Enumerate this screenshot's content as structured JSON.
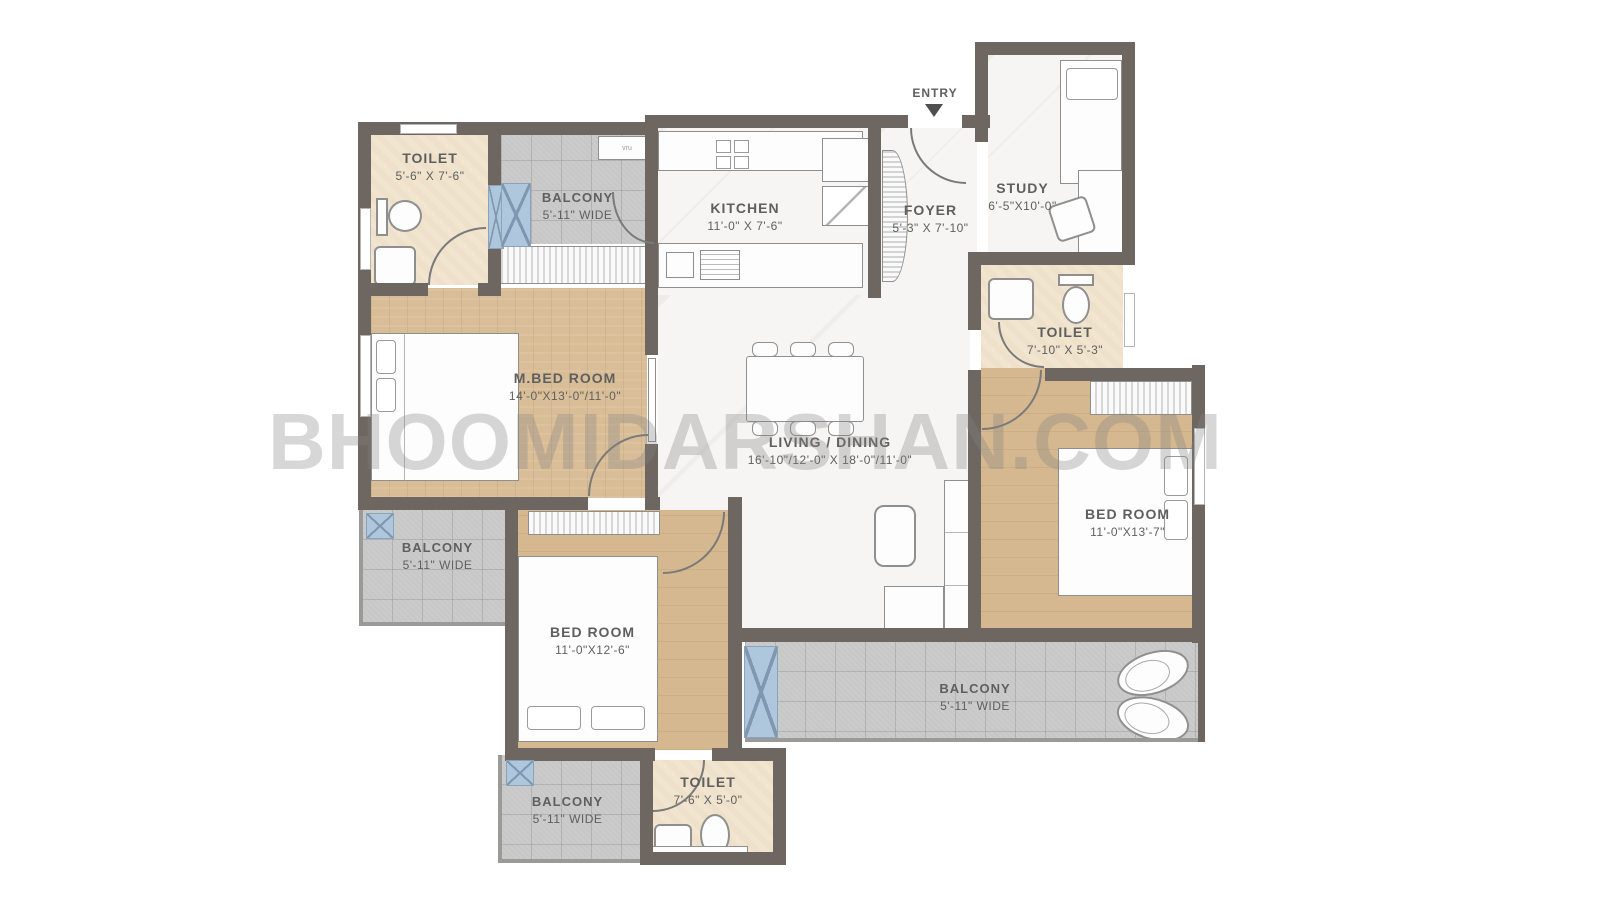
{
  "watermark": "BHOOMIDARSHAN.COM",
  "entry": {
    "label": "ENTRY"
  },
  "misc": {
    "vent_label": "vru"
  },
  "colors": {
    "wall": "#6e6660",
    "wood_floor": "#d9bd97",
    "balcony_tile": "#c7c7c7",
    "toilet_floor": "#f2e5d0",
    "window_blue": "#aec7dd",
    "watermark_gray": "#c4c4c4"
  },
  "rooms": [
    {
      "id": "toilet-top-left",
      "label": "TOILET",
      "dims": "5'-6\" X 7'-6\""
    },
    {
      "id": "balcony-top-left",
      "label": "BALCONY",
      "dims": "5'-11\" WIDE"
    },
    {
      "id": "kitchen",
      "label": "KITCHEN",
      "dims": "11'-0\" X 7'-6\""
    },
    {
      "id": "foyer",
      "label": "FOYER",
      "dims": "5'-3\" X 7'-10\""
    },
    {
      "id": "study",
      "label": "STUDY",
      "dims": "6'-5\"X10'-0\""
    },
    {
      "id": "master-bedroom",
      "label": "M.BED ROOM",
      "dims": "14'-0\"X13'-0\"/11'-0\""
    },
    {
      "id": "toilet-right",
      "label": "TOILET",
      "dims": "7'-10\" X 5'-3\""
    },
    {
      "id": "living-dining",
      "label": "LIVING / DINING",
      "dims": "16'-10\"/12'-0\" X 18'-0\"/11'-0\""
    },
    {
      "id": "bedroom-right",
      "label": "BED ROOM",
      "dims": "11'-0\"X13'-7\""
    },
    {
      "id": "balcony-left",
      "label": "BALCONY",
      "dims": "5'-11\" WIDE"
    },
    {
      "id": "bedroom-bottom-left",
      "label": "BED ROOM",
      "dims": "11'-0\"X12'-6\""
    },
    {
      "id": "balcony-bottom-right",
      "label": "BALCONY",
      "dims": "5'-11\" WIDE"
    },
    {
      "id": "balcony-bottom-left",
      "label": "BALCONY",
      "dims": "5'-11\" WIDE"
    },
    {
      "id": "toilet-bottom",
      "label": "TOILET",
      "dims": "7'-6\" X 5'-0\""
    }
  ]
}
